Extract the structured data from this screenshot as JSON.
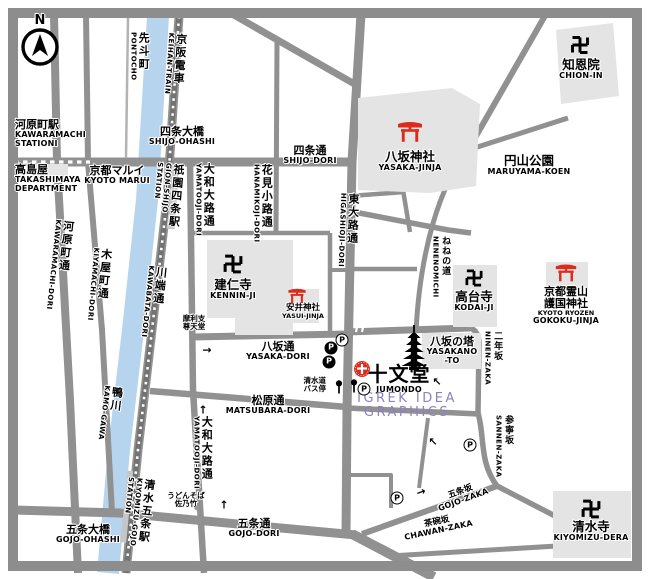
{
  "map": {
    "title": "Kyoto Gion / Higashiyama area map around Jumondo",
    "colors": {
      "road": "#919191",
      "frame": "#8d8d8d",
      "building": "#e4e4e4",
      "station": "#c6c6c6",
      "river": "#b7d4ee",
      "rail": "#737373",
      "accent_red": "#dd2b1c",
      "watermark": "#8e80bd",
      "text": "#000000"
    },
    "compass": {
      "letter": "N"
    },
    "watermark": {
      "line1": "IGREK IDEA",
      "line2": "GRAPHICS"
    },
    "labels": [
      {
        "id": "compass-n",
        "x": 40,
        "y": 14,
        "lines": [
          [
            "N",
            "nlet"
          ]
        ]
      },
      {
        "id": "kawaramachi-station",
        "x": 15,
        "y": 119,
        "align": "left",
        "lines": [
          [
            "河原町駅",
            "jp"
          ],
          [
            "KAWARAMACHI",
            "en"
          ],
          [
            "STATIONI",
            "en"
          ]
        ]
      },
      {
        "id": "takashimaya",
        "x": 15,
        "y": 164,
        "align": "left",
        "lines": [
          [
            "高島屋",
            "jp"
          ],
          [
            "TAKASHIMAYA",
            "en"
          ],
          [
            "DEPARTMENT",
            "en"
          ]
        ]
      },
      {
        "id": "kyoto-marui",
        "x": 117,
        "y": 165,
        "lines": [
          [
            "京都マルイ",
            "jp"
          ],
          [
            "KYOTO MARUI",
            "en"
          ]
        ]
      },
      {
        "id": "pontocho",
        "x": 139,
        "y": 32,
        "vertical": true,
        "lines": [
          [
            "先斗町",
            "vjp"
          ],
          [
            "PONTOCHO",
            "ven"
          ]
        ]
      },
      {
        "id": "keihan-train",
        "x": 177,
        "y": 33,
        "rot": 4,
        "vertical": true,
        "lines": [
          [
            "京阪電車",
            "vjp"
          ],
          [
            "KEIHAN-TRAIN",
            "ven"
          ]
        ]
      },
      {
        "id": "shijo-ohashi",
        "x": 182,
        "y": 126,
        "lines": [
          [
            "四条大橋",
            "jp"
          ],
          [
            "SHIJO-OHASHI",
            "en"
          ]
        ]
      },
      {
        "id": "shijo-dori",
        "x": 310,
        "y": 145,
        "lines": [
          [
            "四条通",
            "jp"
          ],
          [
            "SHIJO-DORI",
            "en"
          ]
        ]
      },
      {
        "id": "kawaramachi-dori",
        "x": 64,
        "y": 220,
        "rot": 6,
        "vertical": true,
        "lines": [
          [
            "河原町通",
            "vjp"
          ],
          [
            "KAWARAMACHI-DORI",
            "ven"
          ]
        ]
      },
      {
        "id": "kiyamachi-dori",
        "x": 102,
        "y": 248,
        "rot": 5,
        "vertical": true,
        "lines": [
          [
            "木屋町通",
            "vjp"
          ],
          [
            "KIYAMACHI-DORI",
            "ven"
          ]
        ]
      },
      {
        "id": "gion-shijo-station",
        "x": 170,
        "y": 163,
        "rot": 5,
        "vertical": true,
        "lines": [
          [
            "祇園四条駅",
            "vjp"
          ],
          [
            "GION-SHIJO",
            "ven"
          ],
          [
            "STATION",
            "ven"
          ]
        ]
      },
      {
        "id": "kawabata-dori",
        "x": 157,
        "y": 266,
        "rot": 6,
        "vertical": true,
        "lines": [
          [
            "川端通",
            "vjp"
          ],
          [
            "KAWABATA-DORI",
            "ven"
          ]
        ]
      },
      {
        "id": "kamo-gawa",
        "x": 113,
        "y": 386,
        "rot": 7,
        "vertical": true,
        "lines": [
          [
            "鴨川",
            "vjp"
          ],
          [
            "KAMO-GAWA",
            "ven"
          ]
        ]
      },
      {
        "id": "kiyomizu-gojo-station",
        "x": 141,
        "y": 478,
        "rot": 6,
        "vertical": true,
        "lines": [
          [
            "清水五条駅",
            "vjp"
          ],
          [
            "KIYOMIZU-GOJO",
            "ven"
          ],
          [
            "STATION",
            "ven"
          ]
        ]
      },
      {
        "id": "yamatooji-dori-north",
        "x": 204,
        "y": 163,
        "vertical": true,
        "lines": [
          [
            "大和大路通",
            "vjp"
          ],
          [
            "YAMATOOJI-DORI",
            "ven"
          ]
        ]
      },
      {
        "id": "yamatooji-dori-south",
        "x": 202,
        "y": 416,
        "vertical": true,
        "lines": [
          [
            "大和大路通",
            "vjp"
          ],
          [
            "YAMATOOJI-DORI",
            "ven"
          ]
        ]
      },
      {
        "id": "hanamikoji-dori",
        "x": 262,
        "y": 164,
        "vertical": true,
        "lines": [
          [
            "花見小路通",
            "vjp"
          ],
          [
            "HANAMIKOJI-DORI",
            "ven"
          ]
        ]
      },
      {
        "id": "higashioji-dori",
        "x": 349,
        "y": 193,
        "rot": 2,
        "vertical": true,
        "lines": [
          [
            "東大路通",
            "vjp"
          ],
          [
            "HIGASHIOJI-DORI",
            "ven"
          ]
        ]
      },
      {
        "id": "nenenomichi",
        "x": 440,
        "y": 236,
        "vertical": true,
        "lines": [
          [
            "ねねの道",
            "vjp-sm"
          ],
          [
            "NENENOMICHI",
            "ven"
          ]
        ]
      },
      {
        "id": "ninen-zaka",
        "x": 492,
        "y": 331,
        "vertical": true,
        "lines": [
          [
            "二年坂",
            "vjp-sm"
          ],
          [
            "NINEN-ZAKA",
            "ven"
          ]
        ]
      },
      {
        "id": "sannen-zaka",
        "x": 503,
        "y": 415,
        "vertical": true,
        "lines": [
          [
            "参寧坂",
            "vjp-sm"
          ],
          [
            "SANNEN-ZAKA",
            "ven"
          ]
        ]
      },
      {
        "id": "maruyama-koen",
        "x": 529,
        "y": 154,
        "lines": [
          [
            "円山公園",
            "jp-lg"
          ],
          [
            "MARUYAMA-KOEN",
            "en"
          ]
        ]
      },
      {
        "id": "chion-in",
        "x": 581,
        "y": 58,
        "lines": [
          [
            "知恩院",
            "jp-lg"
          ],
          [
            "CHION-IN",
            "en"
          ]
        ]
      },
      {
        "id": "yasaka-jinja",
        "x": 410,
        "y": 150,
        "lines": [
          [
            "八坂神社",
            "jp-lg"
          ],
          [
            "YASAKA-JINJA",
            "en"
          ]
        ]
      },
      {
        "id": "kennin-ji",
        "x": 233,
        "y": 278,
        "lines": [
          [
            "建仁寺",
            "jp-lg"
          ],
          [
            "KENNIN-JI",
            "en"
          ]
        ]
      },
      {
        "id": "yasui-jinja",
        "x": 303,
        "y": 304,
        "lines": [
          [
            "安井神社",
            "jp-sm"
          ],
          [
            "YASUI-JINJA",
            "en-sm"
          ]
        ]
      },
      {
        "id": "kodai-ji",
        "x": 474,
        "y": 290,
        "lines": [
          [
            "高台寺",
            "jp-lg"
          ],
          [
            "KODAI-JI",
            "en"
          ]
        ]
      },
      {
        "id": "gokoku-jinja",
        "x": 566,
        "y": 286,
        "lines": [
          [
            "京都霊山",
            "jp"
          ],
          [
            "護国神社",
            "jp"
          ],
          [
            "KYOTO RYOZEN",
            "en-sm"
          ],
          [
            "GOKOKU-JINJA",
            "en"
          ]
        ]
      },
      {
        "id": "kiyomizu-dera",
        "x": 591,
        "y": 520,
        "lines": [
          [
            "清水寺",
            "jp-lg"
          ],
          [
            "KIYOMIZU-DERA",
            "en"
          ]
        ]
      },
      {
        "id": "yasakano-to",
        "x": 452,
        "y": 336,
        "lines": [
          [
            "八坂の塔",
            "jp"
          ],
          [
            "YASAKANO",
            "en"
          ],
          [
            "-TO",
            "en"
          ]
        ]
      },
      {
        "id": "jumondo",
        "x": 399,
        "y": 364,
        "lines": [
          [
            "十文堂",
            "jumbo"
          ],
          [
            "JUMONDO",
            "en"
          ]
        ]
      },
      {
        "id": "yasaka-dori",
        "x": 278,
        "y": 341,
        "lines": [
          [
            "八坂通",
            "jp"
          ],
          [
            "YASAKA-DORI",
            "en"
          ]
        ]
      },
      {
        "id": "matsubara-dori",
        "x": 268,
        "y": 395,
        "lines": [
          [
            "松原通",
            "jp"
          ],
          [
            "MATSUBARA-DORI",
            "en"
          ]
        ]
      },
      {
        "id": "gojo-ohashi",
        "x": 88,
        "y": 524,
        "lines": [
          [
            "五条大橋",
            "jp"
          ],
          [
            "GOJO-OHASHI",
            "en"
          ]
        ]
      },
      {
        "id": "gojo-dori",
        "x": 254,
        "y": 518,
        "lines": [
          [
            "五条通",
            "jp"
          ],
          [
            "GOJO-DORI",
            "en"
          ]
        ]
      },
      {
        "id": "gojo-zaka",
        "x": 459,
        "y": 488,
        "rot": -20,
        "lines": [
          [
            "五条坂",
            "jp-sm"
          ],
          [
            "GOJO-ZAKA",
            "en"
          ]
        ]
      },
      {
        "id": "chawan-zaka",
        "x": 436,
        "y": 518,
        "rot": -12,
        "lines": [
          [
            "茶碗坂",
            "jp-sm"
          ],
          [
            "CHAWAN-ZAKA",
            "en"
          ]
        ]
      },
      {
        "id": "marishisontendo",
        "x": 194,
        "y": 315,
        "lines": [
          [
            "摩利支",
            "note"
          ],
          [
            "尊天堂",
            "note"
          ]
        ]
      },
      {
        "id": "udon-sanotake",
        "x": 186,
        "y": 492,
        "lines": [
          [
            "うどんそば",
            "note"
          ],
          [
            "佐乃竹",
            "note"
          ]
        ]
      },
      {
        "id": "kiyomizu-michi-busstop",
        "x": 326,
        "y": 377,
        "align": "right",
        "lines": [
          [
            "清水道",
            "note"
          ],
          [
            "バス停",
            "note"
          ]
        ]
      },
      {
        "id": "watermark",
        "x": 407,
        "y": 392,
        "wm": true,
        "lines": [
          [
            "IGREK IDEA",
            "wm"
          ],
          [
            "GRAPHICS",
            "wm"
          ]
        ]
      }
    ],
    "icons": [
      {
        "name": "torii-icon",
        "x": 410,
        "y": 132,
        "s": 1.0,
        "red": true
      },
      {
        "name": "torii-icon",
        "x": 297,
        "y": 296,
        "s": 0.72,
        "red": true
      },
      {
        "name": "torii-icon",
        "x": 566,
        "y": 273,
        "s": 0.85,
        "red": true
      },
      {
        "name": "manji-icon",
        "x": 580,
        "y": 45,
        "s": 1.0
      },
      {
        "name": "manji-icon",
        "x": 233,
        "y": 264,
        "s": 1.05
      },
      {
        "name": "manji-icon",
        "x": 474,
        "y": 278,
        "s": 0.95
      },
      {
        "name": "manji-icon",
        "x": 591,
        "y": 509,
        "s": 1.05
      },
      {
        "name": "pagoda-icon",
        "x": 414,
        "y": 348,
        "s": 1.0
      },
      {
        "name": "jumondo-logo-icon",
        "x": 362,
        "y": 369,
        "s": 1.0,
        "red": true
      },
      {
        "name": "bus-stop-icon",
        "x": 339,
        "y": 387,
        "s": 1.0
      },
      {
        "name": "bus-stop-icon",
        "x": 354,
        "y": 386,
        "s": 1.0
      }
    ],
    "parking": [
      {
        "x": 342,
        "y": 340,
        "filled": false
      },
      {
        "x": 331,
        "y": 348,
        "filled": true
      },
      {
        "x": 329,
        "y": 362,
        "filled": true
      },
      {
        "x": 364,
        "y": 389,
        "filled": false
      },
      {
        "x": 470,
        "y": 445,
        "filled": false
      },
      {
        "x": 397,
        "y": 498,
        "filled": false
      }
    ],
    "parking_letter": "P",
    "arrows": [
      {
        "x": 207,
        "y": 350,
        "g": "→"
      },
      {
        "x": 203,
        "y": 410,
        "g": "↑"
      },
      {
        "x": 224,
        "y": 505,
        "g": "↑"
      },
      {
        "x": 437,
        "y": 382,
        "g": "↖"
      },
      {
        "x": 433,
        "y": 442,
        "g": "↖"
      },
      {
        "x": 421,
        "y": 492,
        "g": "→",
        "rot": -20
      }
    ],
    "dots": [
      {
        "x": 197,
        "y": 508
      }
    ]
  }
}
